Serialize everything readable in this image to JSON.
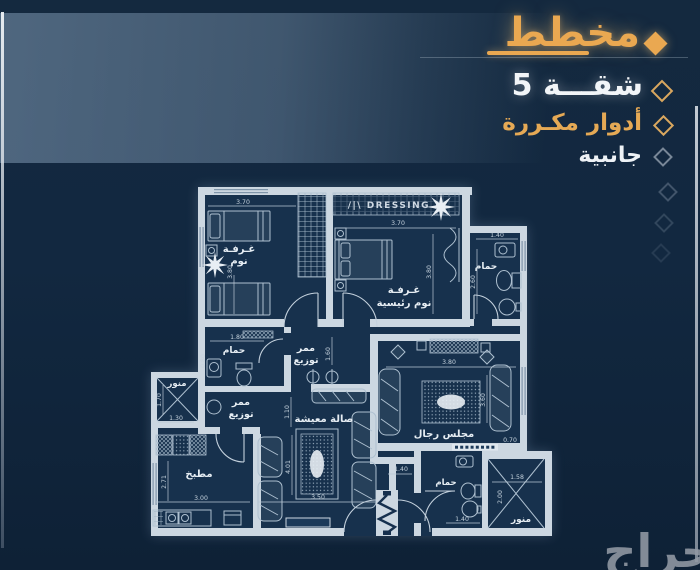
{
  "header": {
    "title": "مخطط",
    "items": [
      {
        "label": "شقـــة 5"
      },
      {
        "label": "أدوار مكـررة"
      },
      {
        "label": "جانبية"
      }
    ]
  },
  "watermark": "حراج",
  "colors": {
    "background": "#12273f",
    "band": "#7c9ab8",
    "accent_gold": "#eaa851",
    "plan_line": "#ccd7e1"
  },
  "plan": {
    "labels": {
      "bedroom_l1": "غـرفـة",
      "bedroom_l2": "نوم",
      "dressing": "/|\\ DRESSING /|",
      "master_l1": "غـرفـة",
      "master_l2": "نوم رئيسية",
      "bath_tr": "حمام",
      "bath_ml": "حمام",
      "corr1_l1": "ممر",
      "corr1_l2": "توزيع",
      "corr2_l1": "ممر",
      "corr2_l2": "توزيع",
      "manwar_l": "منور",
      "kitchen": "مطبخ",
      "living": "صالة معيشة",
      "majlis": "مجلس رجال",
      "bath_br": "حمام",
      "manwar_br": "منور"
    },
    "dims": {
      "bedroom_w": "3.70",
      "bedroom_h": "3.80",
      "master_w": "3.70",
      "master_h": "3.80",
      "bath_tr_w": "1.40",
      "bath_tr_h": "2.60",
      "bath_ml_w": "1.80",
      "bath_ml_h": "0.80",
      "corr1_h": "1.60",
      "corr2_h": "1.10",
      "manwar_l_h": "1.70",
      "manwar_l_w": "1.30",
      "kitchen_h": "2.71",
      "kitchen_w": "3.00",
      "living_h": "4.01",
      "living_w": "3.50",
      "majlis_w": "3.80",
      "majlis_h": "3.60",
      "majlis_d": "0.70",
      "bath_br_w": "1.40",
      "bath_br_w2": "1.40",
      "manwar_br_w": "1.58",
      "manwar_br_h": "2.00"
    }
  }
}
